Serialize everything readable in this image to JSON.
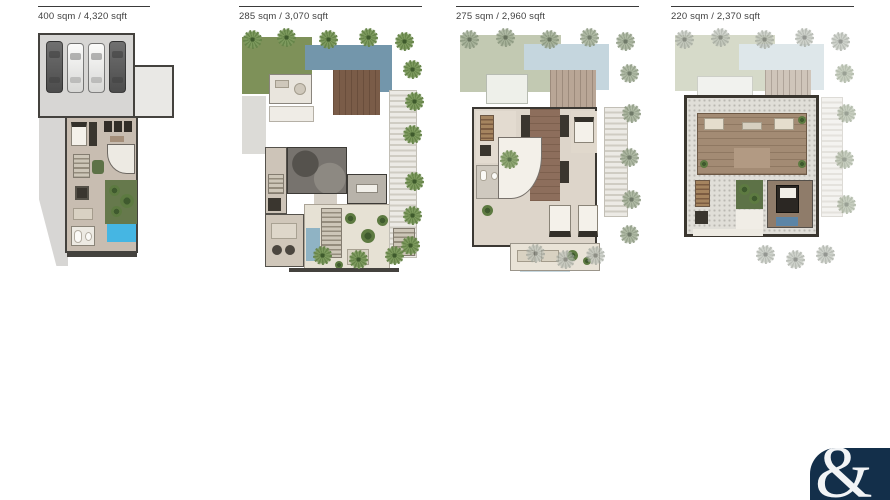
{
  "plans": [
    {
      "area_label": "400 sqm / 4,320 sqft"
    },
    {
      "area_label": "285 sqm / 3,070 sqft"
    },
    {
      "area_label": "275 sqm / 2,960 sqft"
    },
    {
      "area_label": "220 sqm / 2,370 sqft"
    }
  ],
  "logo": {
    "glyph": "&"
  },
  "palette": {
    "page_bg": "#ffffff",
    "label_text": "#3f3f3f",
    "wall_dark": "#44423e",
    "floor_gray": "#d7d6d4",
    "floor_taupe": "#c8bdb1",
    "lawn_green": "#7e9159",
    "lawn_faded": "#c2c9b2",
    "lawn_ghost": "#d6dac9",
    "pool_blue": "#7396ab",
    "pool_bright": "#45b6e3",
    "pool_faded": "#c5d6de",
    "pool_ghost": "#dee7ea",
    "deck_brown": "#7a5c48",
    "palm_green": "#6d8a4c",
    "courtyard_green": "#5d7247",
    "logo_navy": "#132f4a",
    "logo_glyph": "#f2f4f6"
  }
}
